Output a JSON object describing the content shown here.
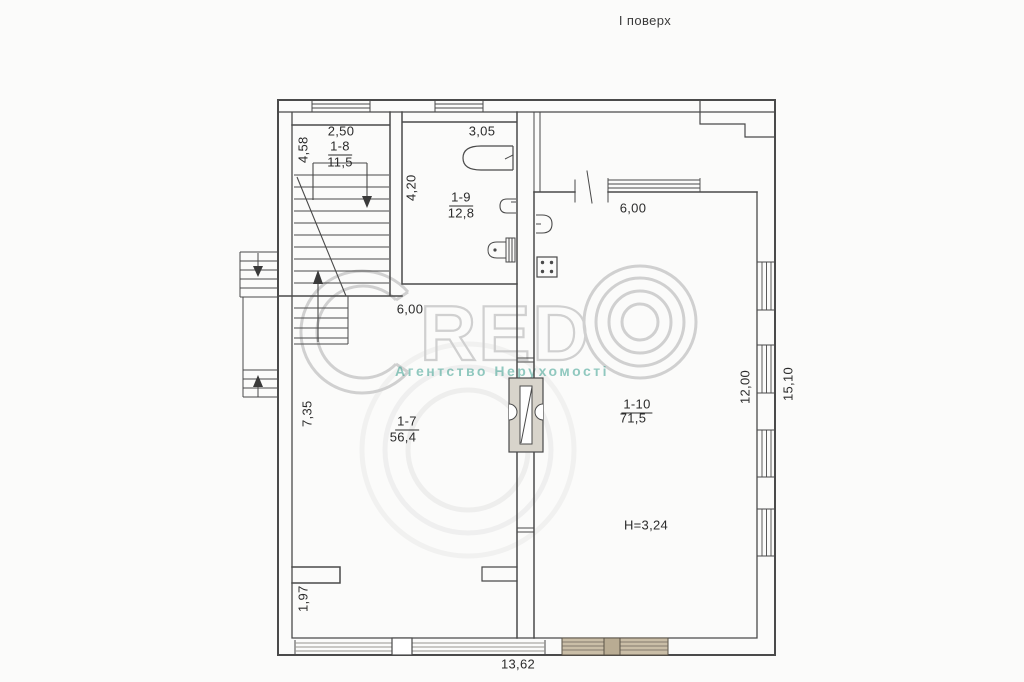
{
  "page": {
    "title": "І поверх"
  },
  "watermark": {
    "brand": "CREDO",
    "brand_letters": "RED",
    "tagline": "Агентство Нерухомості",
    "tagline_color": "#3aa08f",
    "gray": "#d0d0d0"
  },
  "plan": {
    "rooms": [
      {
        "id": "1-8",
        "area": "11,5",
        "kind": "staircase",
        "dims": {
          "width": "2,50",
          "depth": "4,58"
        }
      },
      {
        "id": "1-9",
        "area": "12,8",
        "kind": "bathroom",
        "dims": {
          "width": "3,05",
          "depth": "4,20"
        }
      },
      {
        "id": "1-7",
        "area": "56,4",
        "kind": "room",
        "dims": {
          "width": "6,00",
          "depth": "7,35",
          "nook_depth": "1,97"
        }
      },
      {
        "id": "1-10",
        "area": "71,5",
        "kind": "kitchen-living",
        "dims": {
          "width": "6,00",
          "depth": "12,00"
        },
        "ceiling_height": "H=3,24"
      }
    ],
    "overall": {
      "bottom_width": "13,62",
      "right_height": "15,10"
    }
  }
}
